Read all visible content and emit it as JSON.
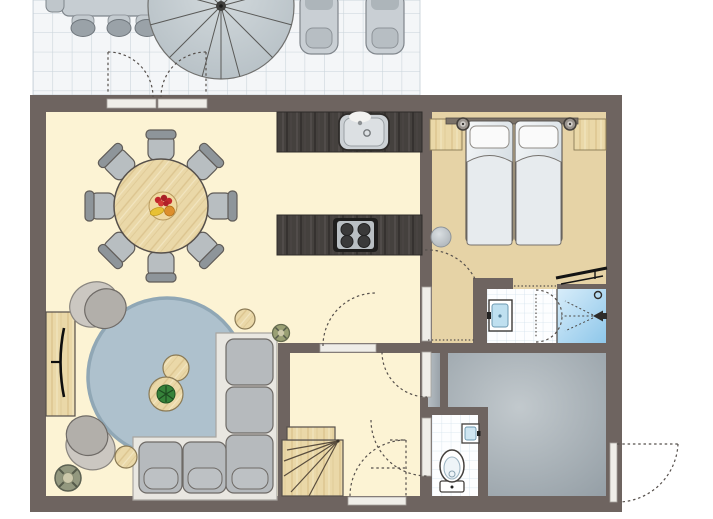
{
  "title": "holiday-home-floor-plan",
  "canvas": {
    "width": 713,
    "height": 519
  },
  "palette": {
    "background": "#ffffff",
    "wall": "#6e6460",
    "living_floor": "#fcf3d4",
    "bedroom_floor": "#e6d3a6",
    "storage_floor": "#9aa3aa",
    "terrace_tile": "#f4f6f8",
    "bath_tile_grout": "#cfe0ea",
    "shower_blue": "#a2d0ec",
    "rug_blue": "#aec1cd",
    "wood_light": "#ead8a8",
    "counter_dark": "#45413e",
    "upholstery_gray": "#b6babd",
    "door_leaf": "#efede8",
    "dashed_line": "#56504c",
    "plant_green": "#36823a",
    "stainless": "#ccd1d5",
    "tv_black": "#0e0e0e"
  },
  "rooms": [
    {
      "name": "terrace",
      "furniture": [
        "outdoor-dining-table",
        "outdoor-chairs",
        "parasol",
        "sun-lounger-left",
        "sun-lounger-right"
      ]
    },
    {
      "name": "living-dining-room",
      "furniture": [
        "round-dining-table",
        "dining-chairs-x8",
        "fruit-bowl",
        "round-rug",
        "corner-sofa",
        "armchair-upper",
        "armchair-lower",
        "coffee-table",
        "coffee-table-with-plant",
        "side-table-upper",
        "side-table-lower",
        "tv-cabinet",
        "tv",
        "potted-plant-corner",
        "potted-plant-small"
      ]
    },
    {
      "name": "kitchen",
      "furniture": [
        "counter-with-sink",
        "island-counter-with-hob",
        "faucet"
      ]
    },
    {
      "name": "bedroom",
      "furniture": [
        "single-bed-left",
        "single-bed-right",
        "headboard-panel",
        "wall-lamp-left",
        "wall-lamp-right",
        "wood-side-panel-left",
        "wood-side-panel-right",
        "round-stool",
        "towel-radiator"
      ]
    },
    {
      "name": "bathroom",
      "furniture": [
        "washbasin",
        "shower",
        "shower-head",
        "shower-control"
      ]
    },
    {
      "name": "hallway",
      "furniture": [
        "winder-staircase"
      ]
    },
    {
      "name": "toilet-room",
      "furniture": [
        "toilet",
        "hand-basin"
      ]
    },
    {
      "name": "storage-room",
      "furniture": []
    }
  ],
  "doors": [
    {
      "name": "terrace-french-doors",
      "type": "double-outward-swing"
    },
    {
      "name": "living-hallway-door",
      "type": "hinged"
    },
    {
      "name": "bedroom-door",
      "type": "hinged"
    },
    {
      "name": "bathroom-door",
      "type": "double-swing"
    },
    {
      "name": "storage-closet-door",
      "type": "hinged"
    },
    {
      "name": "toilet-door",
      "type": "hinged"
    },
    {
      "name": "front-door",
      "type": "hinged"
    },
    {
      "name": "storage-exterior-door",
      "type": "hinged-outward"
    }
  ]
}
